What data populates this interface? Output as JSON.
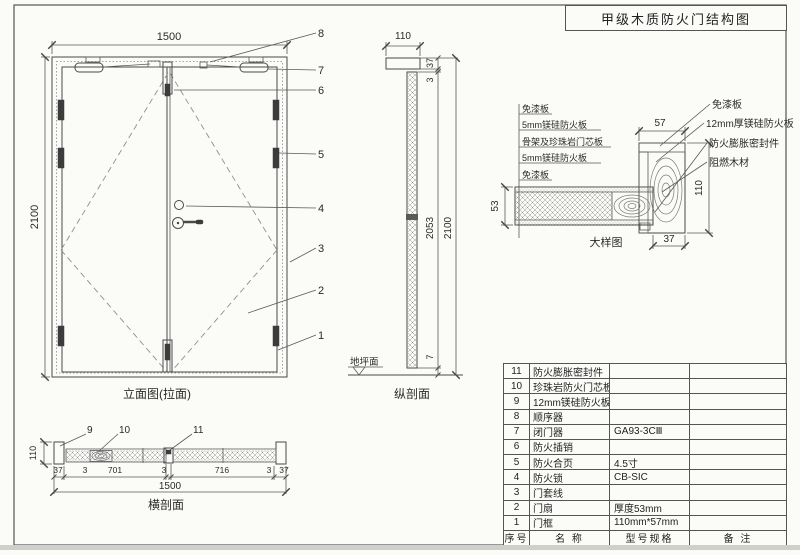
{
  "title": "甲级木质防火门结构图",
  "elevation": {
    "label": "立面图(拉面)",
    "dim_width": "1500",
    "dim_height": "2100",
    "callouts": [
      "8",
      "7",
      "6",
      "5",
      "4",
      "3",
      "2",
      "1"
    ]
  },
  "vsection": {
    "label": "纵剖面",
    "dim_frame": "110",
    "dim_37": "37",
    "dim_3": "3",
    "dim_leaf_h": "2053",
    "dim_total_h": "2100",
    "dim_gap": "7",
    "ground_label": "地坪面"
  },
  "detail": {
    "label": "大样图",
    "layers": [
      "免漆板",
      "5mm镁硅防火板",
      "骨架及珍珠岩门芯板",
      "5mm镁硅防火板",
      "免漆板"
    ],
    "parts": [
      "免漆板",
      "12mm厚镁硅防火板",
      "防火膨胀密封件",
      "阻燃木材"
    ],
    "dim_frame_w": "57",
    "dim_frame_d": "110",
    "dim_leaf_t": "53",
    "dim_stop": "37"
  },
  "hsection": {
    "label": "横剖面",
    "callouts": [
      "9",
      "10",
      "11"
    ],
    "dims": [
      "37",
      "3",
      "701",
      "3",
      "716",
      "3",
      "37"
    ],
    "dim_total": "1500",
    "dim_depth": "110"
  },
  "table": {
    "headers": [
      "序号",
      "名 称",
      "型号规格",
      "备 注"
    ],
    "rows": [
      {
        "no": "11",
        "name": "防火膨胀密封件",
        "spec": "",
        "remark": ""
      },
      {
        "no": "10",
        "name": "珍珠岩防火门芯板",
        "spec": "",
        "remark": ""
      },
      {
        "no": "9",
        "name": "12mm镁硅防火板",
        "spec": "",
        "remark": ""
      },
      {
        "no": "8",
        "name": "顺序器",
        "spec": "",
        "remark": ""
      },
      {
        "no": "7",
        "name": "闭门器",
        "spec": "GA93-3CⅢ",
        "remark": ""
      },
      {
        "no": "6",
        "name": "防火插销",
        "spec": "",
        "remark": ""
      },
      {
        "no": "5",
        "name": "防火合页",
        "spec": "4.5寸",
        "remark": ""
      },
      {
        "no": "4",
        "name": "防火锁",
        "spec": "CB-SIC",
        "remark": ""
      },
      {
        "no": "3",
        "name": "门套线",
        "spec": "",
        "remark": ""
      },
      {
        "no": "2",
        "name": "门扇",
        "spec": "厚度53mm",
        "remark": ""
      },
      {
        "no": "1",
        "name": "门框",
        "spec": "110mm*57mm",
        "remark": ""
      }
    ]
  },
  "colors": {
    "line": "#4a4a4a",
    "text": "#2a2a2a",
    "dark_fill": "#3c3c3c"
  }
}
